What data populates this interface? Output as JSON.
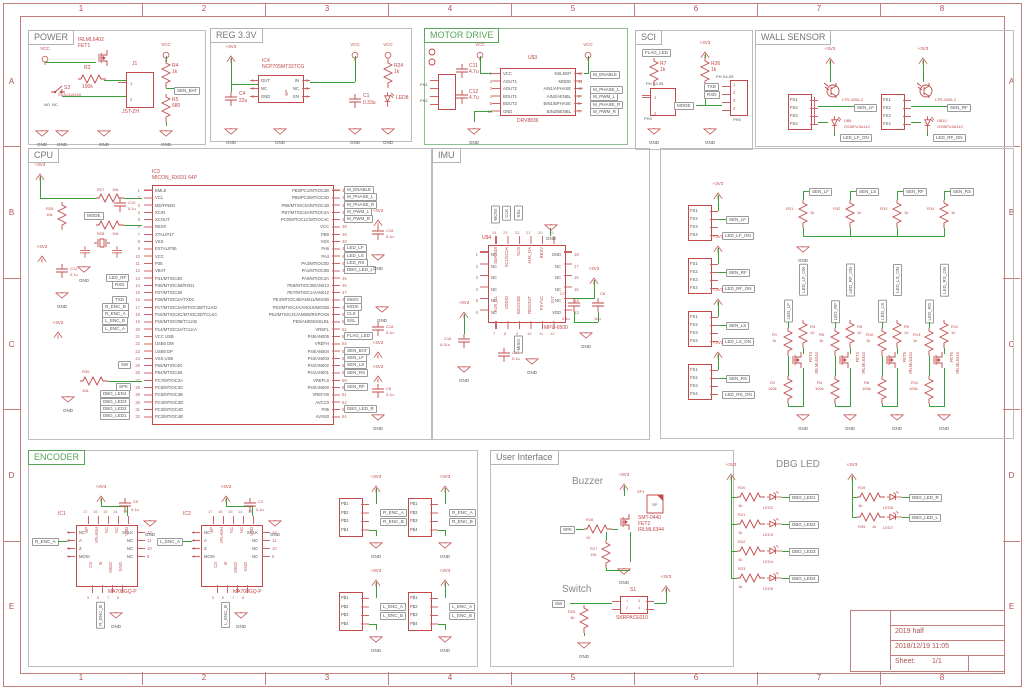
{
  "labels": {
    "gnd": "GND",
    "vcc": "VCC",
    "p3v3": "+3V3"
  },
  "frame": {
    "cols": [
      "1",
      "2",
      "3",
      "4",
      "5",
      "6",
      "7",
      "8"
    ],
    "rows": [
      "A",
      "B",
      "C",
      "D",
      "E"
    ]
  },
  "title_block": {
    "name": "2019 half",
    "date": "2018/12/19 11:05",
    "sheet_label": "Sheet:",
    "sheet_value": "1/1"
  },
  "power": {
    "title": "POWER",
    "fet_part": "IRLML6402",
    "fet_ref": "FET1",
    "r3_ref": "R3",
    "r3_val": "100k",
    "s3_ref": "S3",
    "s3_part": "SSAJ110100",
    "no": "NO",
    "nc": "NC",
    "j_ref": "J1",
    "j_part": "JST-ZH",
    "j_pins": [
      "1",
      "2"
    ],
    "r4_ref": "R4",
    "r4_val": "1k",
    "r5_ref": "R5",
    "r5_val": "680",
    "tag_senbat": "SEN_BAT"
  },
  "reg": {
    "title": "REG 3.3V",
    "ic_ref": "IC4",
    "ic_part": "NCP705MT33TCG",
    "left": [
      "OUT",
      "NC",
      "GND"
    ],
    "lnum": [
      "1",
      "2",
      "3"
    ],
    "right": [
      "IN",
      "NC",
      "EN"
    ],
    "rnum": [
      "5",
      "6",
      "4"
    ],
    "ep": "EP",
    "c4_ref": "C4",
    "c4_val": "22u",
    "c1_ref": "C1",
    "c1_val": "0.33u",
    "r24_ref": "R24",
    "r24_val": "1k",
    "led_ref": "LED8"
  },
  "motor": {
    "title": "MOTOR DRIVE",
    "ic_ref": "U$3",
    "ic_part": "DRV8836",
    "left": [
      "VCC",
      "AOUT1",
      "AOUT2",
      "BOUT1",
      "BOUT2",
      "GND"
    ],
    "lnum": [
      "1",
      "2",
      "3",
      "4",
      "5",
      "13"
    ],
    "right": [
      "NSLEEP",
      "MODE",
      "AIN1/APHASE",
      "AIN2/AENBL",
      "BIN1/BPHASE",
      "BIN2/BENBL"
    ],
    "rnum": [
      "12",
      "11",
      "10",
      "9",
      "8",
      "7"
    ],
    "tags": [
      "M_ENABLE",
      "M_PHASE_L",
      "M_PWM_L",
      "M_PHASE_R",
      "M_PWM_R"
    ],
    "c11_ref": "C11",
    "c11_val": "4.7u",
    "c12_ref": "C12",
    "c12_val": "4.7u",
    "ph1": "PH1",
    "ph2": "PH2"
  },
  "sci": {
    "title": "SCI",
    "tag_flag": "FLAG_LED",
    "r7_ref": "R7",
    "r7_val": "1k",
    "conn1_label": "PH X2-05",
    "conn1_ref": "PH3",
    "conn1_pins": [
      "1",
      "2"
    ],
    "r26_ref": "R26",
    "r26_val": "1k",
    "tag_mode": "MODE",
    "tag_txd": "TXD",
    "tag_rxd": "RXD",
    "conn2_label": "PH X4-05",
    "conn2_ref": "PH5",
    "conn2_pins": [
      "1",
      "2",
      "3",
      "4"
    ]
  },
  "wall": {
    "title": "WALL SENSOR",
    "conn_pins": [
      "FS1",
      "FS2",
      "FS3",
      "FS4"
    ],
    "modules": [
      {
        "pt_part": "LTR-4206-2",
        "sen": "SEN_LF",
        "led_ref": "U$9",
        "led_part": "OSI5FU3A11C",
        "led_on": "LED_LF_ON"
      },
      {
        "pt_part": "LTR-4206-2",
        "sen": "SEN_RF",
        "led_ref": "U$10",
        "led_part": "OSI5FU3A11C",
        "led_on": "LED_RF_ON"
      }
    ],
    "conns": [
      {
        "sen": "SEN_LF",
        "led_on": "LED_LF_ON"
      },
      {
        "sen": "SEN_RF",
        "led_on": "LED_RF_ON"
      },
      {
        "sen": "SEN_LS",
        "led_on": "LED_LS_ON"
      },
      {
        "sen": "SEN_RS",
        "led_on": "LED_RS_ON"
      }
    ],
    "pulldowns": [
      {
        "ref": "R31",
        "val": "1k",
        "tag": "SEN_LF"
      },
      {
        "ref": "R32",
        "val": "1k",
        "tag": "SEN_LS"
      },
      {
        "ref": "R33",
        "val": "1k",
        "tag": "SEN_RF"
      },
      {
        "ref": "R34",
        "val": "1k",
        "tag": "SEN_RS"
      }
    ],
    "drivers": [
      {
        "net": "LED_LF",
        "on": "LED_LF_ON",
        "rg_ref": "R1",
        "rg_val": "1k",
        "rd_ref": "R3",
        "rd_val": "10",
        "fet_ref": "FET3",
        "fet_part": "IRLML6344",
        "rpd_ref": "R2",
        "rpd_val": "100k"
      },
      {
        "net": "LED_RF",
        "on": "LED_RF_ON",
        "rg_ref": "R6",
        "rg_val": "1k",
        "rd_ref": "R5",
        "rd_val": "10",
        "fet_ref": "FET4",
        "fet_part": "IRLML6344",
        "rpd_ref": "R4",
        "rpd_val": "100k"
      },
      {
        "net": "LED_LS",
        "on": "LED_LS_ON",
        "rg_ref": "R10",
        "rg_val": "1k",
        "rd_ref": "R9",
        "rd_val": "10",
        "fet_ref": "FET5",
        "fet_part": "IRLML6344",
        "rpd_ref": "R8",
        "rpd_val": "100k"
      },
      {
        "net": "LED_RS",
        "on": "LED_RS_ON",
        "rg_ref": "R13",
        "rg_val": "1k",
        "rd_ref": "R12",
        "rd_val": "10",
        "fet_ref": "FET6",
        "fet_part": "IRLML6344",
        "rpd_ref": "R11",
        "rpd_val": "100k"
      }
    ]
  },
  "cpu": {
    "title": "CPU",
    "ic_ref": "IC3",
    "ic_part": "MICON_RX631 64P",
    "left": [
      "EMLE",
      "VCL",
      "MD/FINED",
      "XCIN",
      "XCOUT",
      "RES#",
      "XTAL/P37",
      "VSS",
      "EXTAL/P36",
      "VCC",
      "P35",
      "VBAT",
      "P31/MTIOC4D",
      "P30/MTIOC4B/RXD1",
      "P27/MTIOC2B",
      "P26/MTIOC2A/TXD1",
      "P17/MTIOC3A/MTIOC3B/TCLKD",
      "P16/MTIOC3C/MTIOC3D/TCLKC",
      "P15/MTIOC0B/TCLKB",
      "P14/MTIOC3A/TCLKA",
      "VCC USB",
      "USB0 DM",
      "USB0 DP",
      "VSS USB",
      "P55/MTIOC4D",
      "P54/MTIOC4B",
      "PC7/MTIOC3A",
      "PC6/MTIOC3C",
      "PC5/MTIOC3B",
      "PC4/MTIOC3D",
      "PC3/MTIOC4D",
      "PC2/MTIOC4B"
    ],
    "lnum": [
      "1",
      "2",
      "3",
      "4",
      "5",
      "6",
      "7",
      "8",
      "9",
      "10",
      "11",
      "12",
      "13",
      "14",
      "15",
      "16",
      "17",
      "18",
      "19",
      "20",
      "21",
      "22",
      "23",
      "24",
      "25",
      "26",
      "27",
      "28",
      "29",
      "30",
      "31",
      "32"
    ],
    "right": [
      "PB3/PC1/MTIOC2B",
      "PB5/PC3/MTIOC2D",
      "PB6/MTIOC3A/MTIOC1B",
      "PB7/MTIOC3A/MTIOC4A",
      "PC0/MTIOC1C/MTIOC4C",
      "VCC",
      "PB0",
      "VSS",
      "PA6",
      "PA4",
      "PA3/MTIOC0D",
      "PA1/MTIOC0B",
      "PA0/MTIOC4A",
      "PE6/MTIOC2B/AN013",
      "PE7/MTIOC1A/AN012",
      "PE4/MTIOC4B/AN011/MISOB",
      "PE3/MTIOC4A/AN010/MOSIB",
      "PE2/MTIOC4C/AN008/RSPCKB",
      "PE5/AN005/SSLB1",
      "VREFL",
      "P45/AN005",
      "VREFH",
      "P46/AN004",
      "P43/AN003",
      "P42/AN002",
      "P41/AN001",
      "VREFL0",
      "P40/AN000",
      "VREFH0",
      "AVCC0",
      "P05",
      "AVSS0"
    ],
    "rnum": [
      "33",
      "34",
      "35",
      "36",
      "37",
      "38",
      "39",
      "40",
      "41",
      "42",
      "43",
      "44",
      "45",
      "46",
      "47",
      "48",
      "49",
      "50",
      "51",
      "52",
      "53",
      "54",
      "55",
      "56",
      "57",
      "58",
      "59",
      "60",
      "61",
      "62",
      "63",
      "64"
    ],
    "tags_left": [
      "MODE",
      "LED_RF",
      "RXD",
      "TXD",
      "R_ENC_B",
      "R_ENC_A",
      "L_ENC_B",
      "L_ENC_A",
      "SW",
      "SPK",
      "DBG_LED4",
      "DBG_LED3",
      "DBG_LED2",
      "DBG_LED1"
    ],
    "tags_right": [
      "M_ENABLE",
      "M_PHASE_L",
      "M_PHASE_R",
      "M_PWM_L",
      "M_PWM_R",
      "LED_LF",
      "LED_LS",
      "LED_RS",
      "DBG_LED_L",
      "MISO",
      "MOSI",
      "CLK",
      "SSL",
      "FLAG_LED",
      "SEN_BAT",
      "SEN_LF",
      "SEN_LS",
      "SEN_RS",
      "SEN_RF",
      "DBG_LED_R"
    ],
    "r27_ref": "R27",
    "r27_val": "10k",
    "r28_ref": "R28",
    "r28_val": "10k",
    "r29_ref": "R29",
    "r29_val": "10k",
    "r30_ref": "R30",
    "r30_val": "10k",
    "c10_ref": "C10",
    "c10_val": "0.1u",
    "c13_ref": "C13",
    "c13_val": "0.1u",
    "c15_ref": "C15",
    "c15_val": "0.1u",
    "c18_ref": "C18",
    "c18_val": "0.1u",
    "c6_ref": "C6",
    "c6_val": "0.1u"
  },
  "imu": {
    "title": "IMU",
    "ic_ref": "U$4",
    "ic_part": "MPU-6500",
    "left": [
      "NC",
      "NC",
      "NC",
      "NC",
      "NC",
      "NC"
    ],
    "lnum": [
      "1",
      "2",
      "3",
      "4",
      "5",
      "6"
    ],
    "right": [
      "GND",
      "NC",
      "NC",
      "NC",
      "NC",
      "VDD"
    ],
    "rnum": [
      "18",
      "17",
      "16",
      "15",
      "14",
      "13"
    ],
    "top": [
      "SDA/SDI",
      "SCL/SCLK",
      "NCS",
      "AUX_DA",
      "RESV"
    ],
    "tnum": [
      "24",
      "23",
      "22",
      "21",
      "20",
      "19"
    ],
    "bottom": [
      "AUX_CL",
      "VDDIO",
      "SDO/AD0",
      "REGOUT",
      "FSYNC",
      "INT"
    ],
    "bnum": [
      "7",
      "8",
      "9",
      "10",
      "11",
      "12"
    ],
    "tag_mosi": "MOSI",
    "tag_clk": "CLK",
    "tag_ssl": "SSL",
    "tag_miso": "MISO",
    "c16_ref": "C16",
    "c16_val": "0.01u",
    "c17_ref": "C17",
    "c17_val": "0.1u",
    "c7_ref": "C7",
    "c7_val": "0.1u",
    "c8_ref": "C8",
    "c8_val": "10u"
  },
  "encoder": {
    "title": "ENCODER",
    "pins": {
      "left": [
        "NC",
        "A",
        "Z",
        "MOSI"
      ],
      "lnum": [
        "1",
        "2",
        "3",
        "4"
      ],
      "right": [
        "SCLK",
        "NC",
        "NC",
        "NC"
      ],
      "rnum": [
        "12",
        "11",
        "10",
        "9"
      ],
      "top": [
        "EP",
        "VFLASH",
        "NC",
        "NC",
        "VDD"
      ],
      "tnum": [
        "17",
        "16",
        "15",
        "14",
        "13"
      ],
      "bottom": [
        "CS",
        "B",
        "MISO",
        "GND"
      ],
      "bnum": [
        "5",
        "6",
        "7",
        "8"
      ]
    },
    "ics": [
      {
        "ref": "IC1",
        "part": "MA700GQ-P",
        "a": "R_ENC_A",
        "b": "R_ENC_B",
        "cap_ref": "C5",
        "cap_val": "0.1u"
      },
      {
        "ref": "IC2",
        "part": "MA700GQ-P",
        "a": "L_ENC_A",
        "b": "L_ENC_B",
        "cap_ref": "C2",
        "cap_val": "0.1u"
      }
    ],
    "conn_pins": [
      "P$1",
      "P$2",
      "P$3",
      "P$4"
    ],
    "conns": [
      {
        "a": "R_ENC_A",
        "b": "R_ENC_B"
      },
      {
        "a": "R_ENC_A",
        "b": "R_ENC_B"
      },
      {
        "a": "L_ENC_A",
        "b": "L_ENC_B"
      },
      {
        "a": "L_ENC_A",
        "b": "L_ENC_B"
      }
    ]
  },
  "ui": {
    "title": "User Interface",
    "buzzer_heading": "Buzzer",
    "sp_ref": "SP1",
    "sp_txt": "SP",
    "sp_part": "SMT-0440",
    "fet_ref": "FET2",
    "fet_part": "IRLML6344",
    "r16_ref": "R16",
    "r16_val": "10",
    "r17_ref": "R17",
    "r17_val": "10k",
    "tag_spk": "SPK",
    "switch_heading": "Switch",
    "s_ref": "S1",
    "s_part": "SKRPACE010",
    "s_pins": [
      "1",
      "2",
      "3",
      "4"
    ],
    "r25_ref": "R25",
    "r25_val": "1k",
    "tag_sw": "SW"
  },
  "dbg": {
    "title": "DBG LED",
    "group1": [
      {
        "r_ref": "R20",
        "r_val": "1k",
        "led": "LED2",
        "tag": "DBG_LED1"
      },
      {
        "r_ref": "R21",
        "r_val": "1k",
        "led": "LED3",
        "tag": "DBG_LED2"
      },
      {
        "r_ref": "R22",
        "r_val": "1k",
        "led": "LED4",
        "tag": "DBG_LED3"
      },
      {
        "r_ref": "R23",
        "r_val": "1k",
        "led": "LED5",
        "tag": "DBG_LED4"
      }
    ],
    "group2": [
      {
        "r_ref": "R19",
        "r_val": "1k",
        "led": "LED6",
        "tag": "DBG_LED_R"
      },
      {
        "r_ref": "R35",
        "r_val": "1k",
        "led": "LED7",
        "tag": "DBG_LED_L"
      }
    ]
  }
}
